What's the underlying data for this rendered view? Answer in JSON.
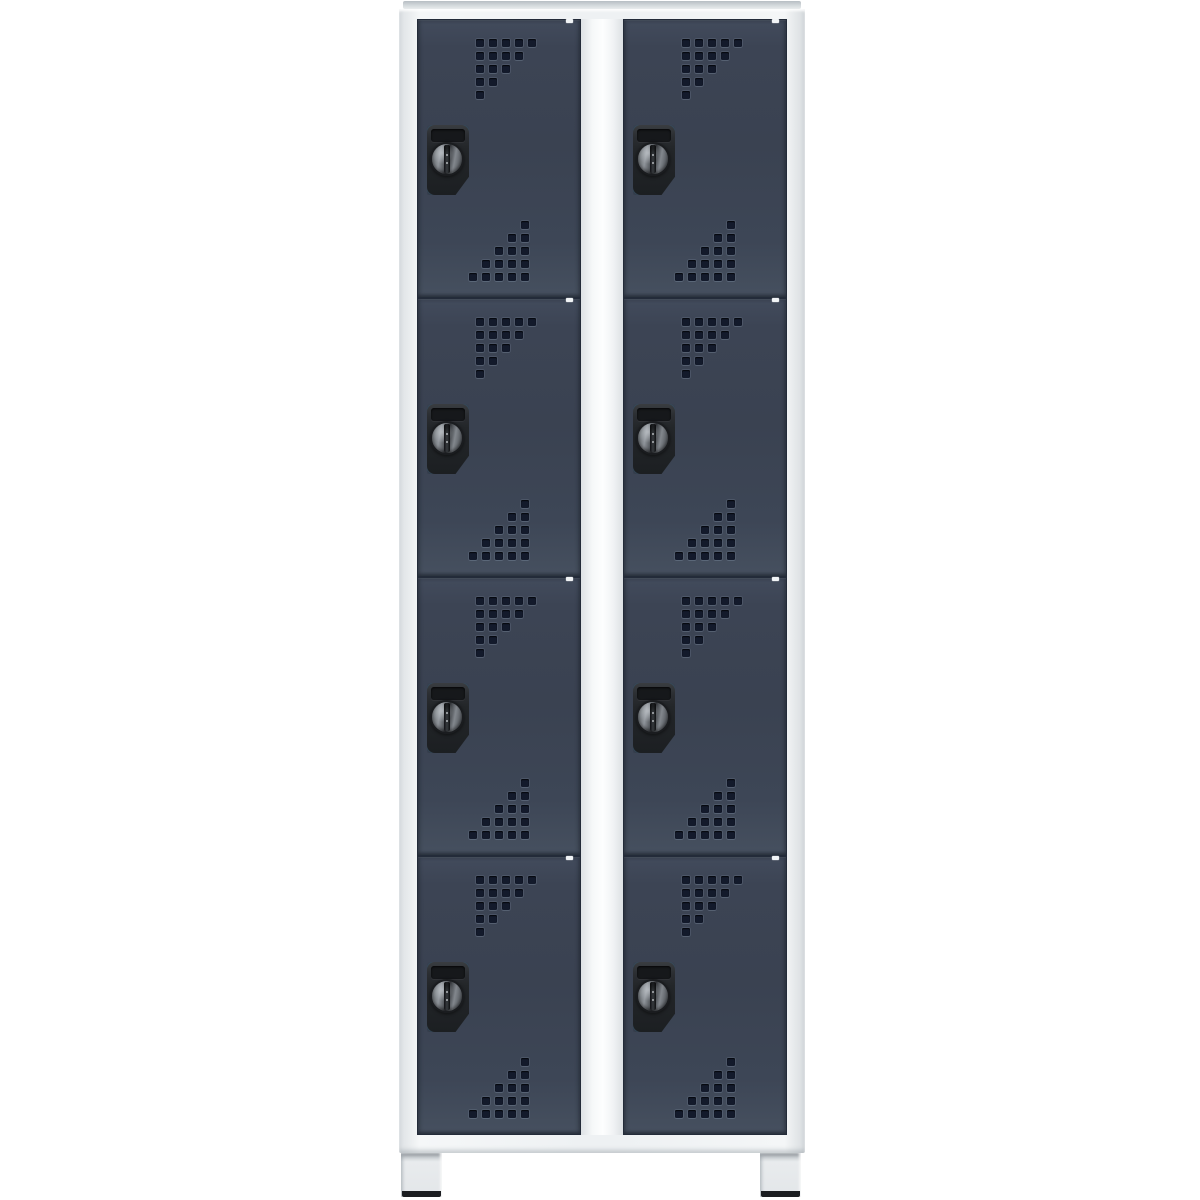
{
  "page": {
    "background": "#ffffff",
    "subject": "product-photo-of-compartment-locker-cabinet"
  },
  "cabinet": {
    "columns": 2,
    "rows_per_column": 4,
    "total_compartments": 8,
    "feet_count": 2,
    "colors": {
      "background": "#ffffff",
      "frame": "#eef1f3",
      "frame_shadow": "#d8dcdf",
      "top_edge": "#c3c9cd",
      "mullion_highlight": "#fdfefe",
      "door_face": "#3a4251",
      "door_face_light": "#424b5c",
      "door_edge": "#232b39",
      "perforation_hole": "#131a2b",
      "lock_plate": "#232629",
      "lock_knob_metal": "#90959b",
      "catch_highlight": "#f1f4f6",
      "foot": "#e3e6e9",
      "foot_tip": "#1b1d20"
    },
    "door": {
      "lock_type": "rotary-cylinder-lock",
      "hole_size_px": 8,
      "hole_pitch_px": 13,
      "perforation_top": {
        "rows": [
          5,
          4,
          3,
          2,
          1
        ],
        "align": "left"
      },
      "perforation_bottom": {
        "rows": [
          1,
          2,
          3,
          4,
          5
        ],
        "align": "right"
      }
    }
  }
}
